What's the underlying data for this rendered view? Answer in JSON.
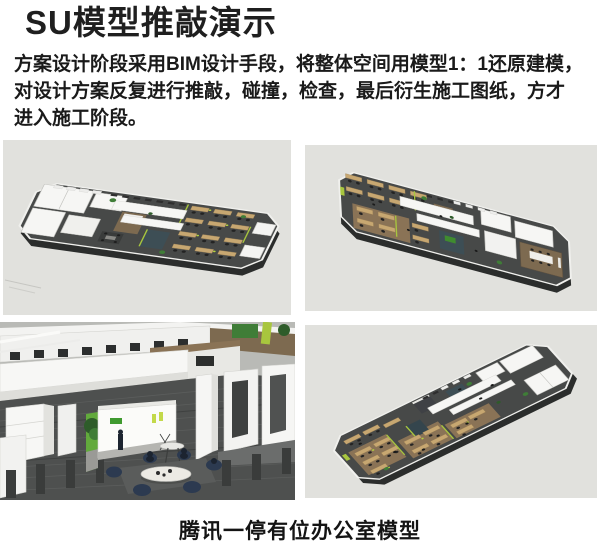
{
  "header": {
    "title": "SU模型推敲演示"
  },
  "intro": {
    "lines": [
      "方案设计阶段采用BIM设计手段，将整体空间用模型1：1还原建模，",
      "对设计方案反复进行推敲，碰撞，检查，最后衍生施工图纸，方才",
      "进入施工阶段。"
    ]
  },
  "figures": [
    {
      "name": "su-model-aerial-view-northwest"
    },
    {
      "name": "su-model-aerial-view-northeast"
    },
    {
      "name": "su-model-interior-lobby-view"
    },
    {
      "name": "su-model-aerial-view-southeast"
    }
  ],
  "caption": {
    "text": "腾讯一停有位办公室模型"
  },
  "colors": {
    "render_background": "#e1e1dd",
    "floor_dark": "#474948",
    "wall_white": "#f6f6f4",
    "wood_desk": "#c7a771",
    "wood_wall": "#7d6a50",
    "accent_lime": "#a8c63e",
    "plant_green": "#3f7d37",
    "teal_panel": "#3d4e55"
  }
}
